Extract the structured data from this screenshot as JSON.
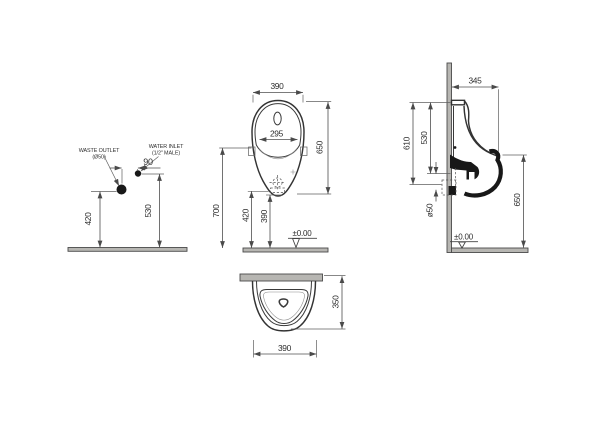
{
  "drawing": {
    "installation": {
      "waste_label_1": "WASTE OUTLET",
      "waste_label_2": "(Ø50)",
      "inlet_label_1": "WATER INLET",
      "inlet_label_2": "(1/2\" MALE)",
      "dim_spacing": "90",
      "dim_waste_height": "420",
      "dim_inlet_height": "530"
    },
    "front": {
      "dim_width": "390",
      "dim_bowl_width": "295",
      "dim_height": "650",
      "dim_mount_height": "700",
      "dim_outlet_height": "420",
      "dim_bottom_clearance": "390",
      "datum": "±0.00"
    },
    "side": {
      "dim_depth": "345",
      "dim_upper": "610",
      "dim_lower": "530",
      "dim_waste_pipe": "ø50",
      "dim_spout_height": "650",
      "datum": "±0.00"
    },
    "top": {
      "dim_depth": "350",
      "dim_width": "390"
    }
  },
  "colors": {
    "line": "#333333",
    "dimension_line": "#4f4f4f",
    "text": "#2d2d2d",
    "section_fill": "#181818",
    "surface_bar": "#b7b6b2",
    "background": "#ffffff"
  }
}
